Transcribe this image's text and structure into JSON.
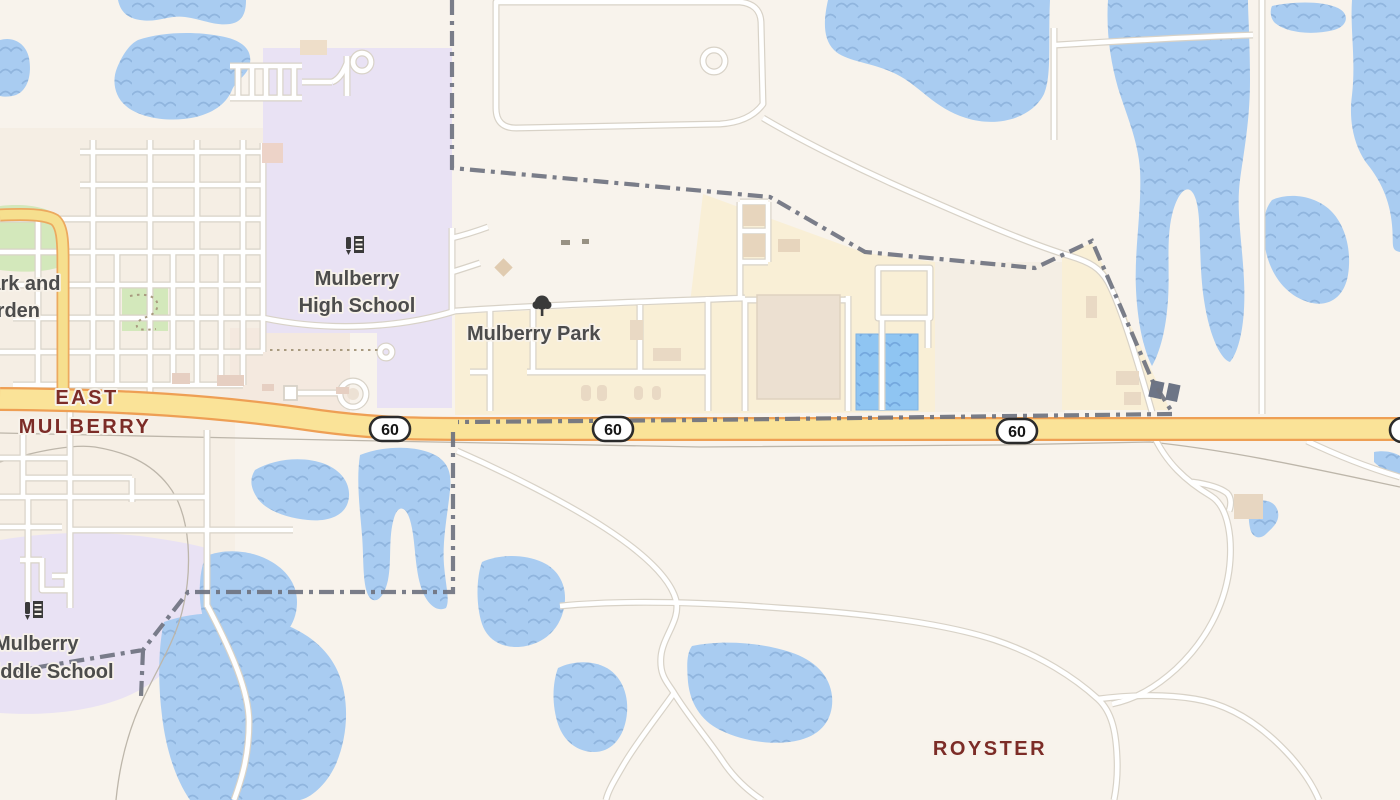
{
  "map": {
    "place_labels": {
      "east_mulberry_line1": "EAST",
      "east_mulberry_line2": "MULBERRY",
      "royster": "ROYSTER"
    },
    "poi_labels": {
      "high_school_line1": "Mulberry",
      "high_school_line2": "High School",
      "park": "Mulberry Park",
      "garden_line1": "Park and",
      "garden_line2": "Garden",
      "middle_school_line1": "Mulberry",
      "middle_school_line2": "Middle School"
    },
    "route_shields": [
      {
        "number": "60"
      },
      {
        "number": "60"
      },
      {
        "number": "60"
      },
      {
        "number": "60"
      }
    ],
    "icons": {
      "high_school": "school-icon",
      "middle_school": "school-icon",
      "mulberry_park": "tree-icon"
    },
    "colors": {
      "land": "#f8f3ec",
      "district_tint": "#f3eade",
      "water": "#a9ccf1",
      "water_wave": "#90b5de",
      "pond_blue": "#8fc5f2",
      "park_green": "#d3e8bb",
      "campus_purple": "#e9e2f4",
      "park_cream": "#f9efd6",
      "highway_fill": "#fae398",
      "highway_casing": "#ee9f54",
      "road_fill": "#ffffff",
      "road_casing": "#d8d2c7",
      "boundary_gray": "#6f7380",
      "railroad_gray": "#bdb6aa",
      "place_label": "#7c2c27",
      "poi_label": "#4c4c4c",
      "building_tan": "#e9d9c4",
      "icon_dark": "#3a3a3a"
    }
  }
}
